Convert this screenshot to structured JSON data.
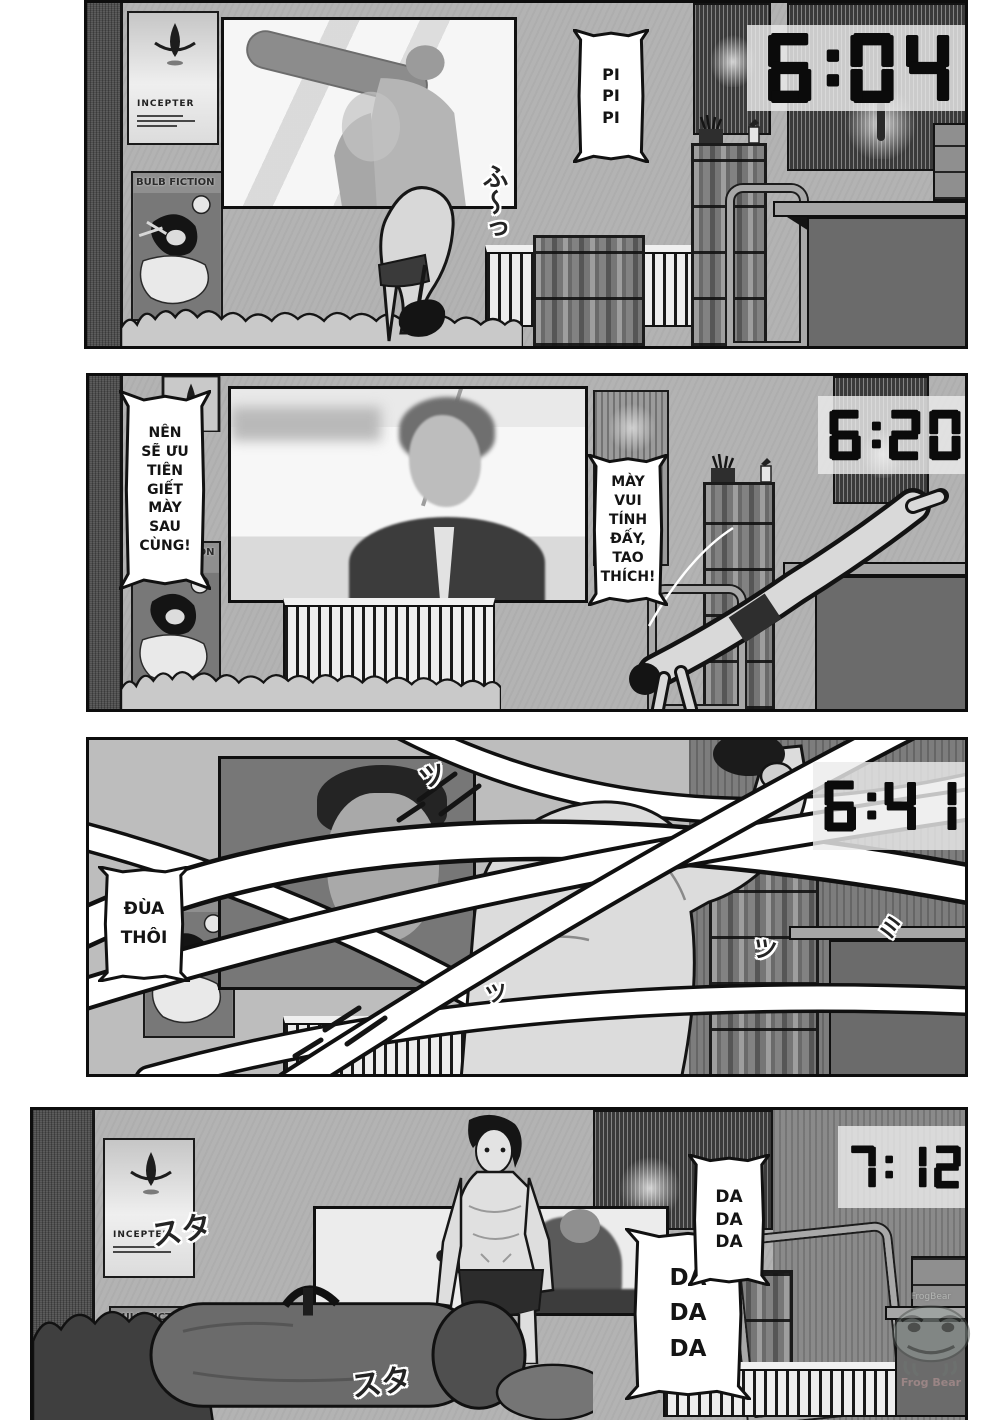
{
  "page": {
    "width": 1000,
    "height": 1420,
    "background": "#ffffff"
  },
  "colors": {
    "ink": "#111111",
    "wall": "#b3b3b3",
    "wall_dark": "#4e4e4e",
    "clock_bg": "rgba(236,236,236,0.82)",
    "clock_digits": "#0b0b0b",
    "bubble_fill": "#ffffff"
  },
  "posters": {
    "incepter": {
      "title": "INCEPTER"
    },
    "bulb_fiction": {
      "title": "BULB FICTION"
    }
  },
  "panels": [
    {
      "time": "6:04",
      "bubbles": [
        {
          "lines": [
            "PI",
            "PI",
            "PI"
          ]
        }
      ],
      "sfx": [
        "ふ〜っ"
      ]
    },
    {
      "time": "6:20",
      "bubbles": [
        {
          "lines": [
            "NÊN",
            "SẼ ƯU",
            "TIÊN",
            "GIẾT",
            "MÀY",
            "SAU",
            "CÙNG!"
          ]
        },
        {
          "lines": [
            "MÀY",
            "VUI",
            "TÍNH",
            "ĐẤY,",
            "TAO",
            "THÍCH!"
          ]
        }
      ],
      "sfx": []
    },
    {
      "time": "6:41",
      "bubbles": [
        {
          "lines": [
            "ĐÙA",
            "THÔI"
          ]
        }
      ],
      "sfx": [
        "ツ",
        "ツ",
        "ミ",
        "ツ"
      ]
    },
    {
      "time": "7:12",
      "bubbles": [
        {
          "lines": [
            "DA",
            "DA",
            "DA"
          ]
        },
        {
          "lines": [
            "DA",
            "DA",
            "DA"
          ]
        }
      ],
      "sfx": [
        "スタ",
        "スタ"
      ]
    }
  ],
  "watermark": {
    "line1": "FrogBear",
    "line2": "Frog Bear"
  }
}
